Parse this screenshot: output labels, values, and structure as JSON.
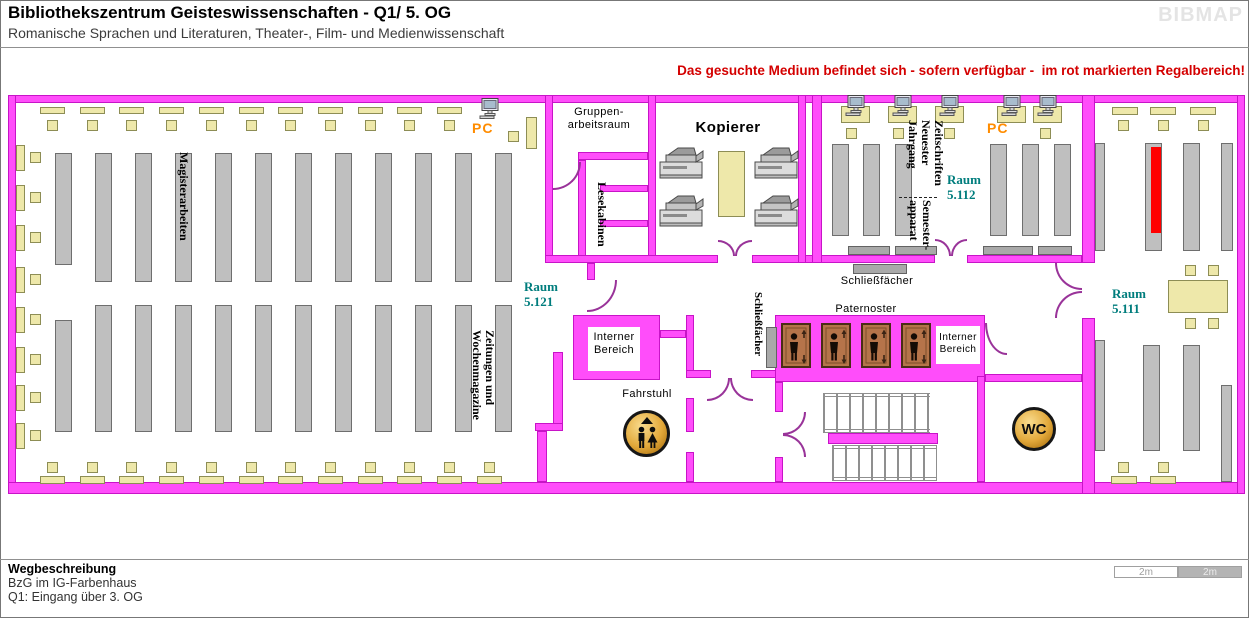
{
  "header": {
    "title": "Bibliothekszentrum Geisteswissenschaften - Q1/ 5. OG",
    "subtitle": "Romanische Sprachen und Literaturen, Theater-, Film- und Medienwissenschaft",
    "logo": "BIBMAP",
    "notice": "Das gesuchte Medium befindet sich - sofern verfügbar -  im rot markierten Regalbereich!"
  },
  "plan": {
    "rooms": {
      "gruppenarbeitsraum": "Gruppen-\narbeitsraum",
      "lesekabinen": "Lesekabinen",
      "kopierer": "Kopierer",
      "raum_5121": "Raum\n5.121",
      "raum_5112": "Raum\n5.112",
      "raum_5111": "Raum\n5.111",
      "interner_bereich_links": "Interner\nBereich",
      "interner_bereich_rechts": "Interner\nBereich",
      "fahrstuhl": "Fahrstuhl",
      "wc": "WC",
      "paternoster": "Paternoster"
    },
    "areas": {
      "magisterarbeiten": "Magisterarbeiten",
      "zeitungen": "Zeitungen und\nWochenmagazine",
      "zeitschriften": "Zeitschriften\nNeuester\nJahrgang",
      "semesterapparat": "Semester-\napparat",
      "schliessfaecher_oben": "Schließfächer",
      "schliessfaecher_flur": "Schließfächer",
      "pc_links": "PC",
      "pc_rechts": "PC"
    }
  },
  "footer": {
    "heading": "Wegbeschreibung",
    "line1": "BzG im IG-Farbenhaus",
    "line2": "Q1: Eingang über 3. OG",
    "scale_left": "2m",
    "scale_right": "2m"
  },
  "icons": {
    "computer": "monitor-icon",
    "kopierer": "copier-icon",
    "fahrstuhl": "elevator-people-up-icon",
    "wc": "wc-circle-icon",
    "paternoster": "person-in-cabin-icon",
    "treppe": "stairs-flight"
  },
  "colors": {
    "wall": "#ff4dfa",
    "wallb": "#c714c7",
    "door": "#993399",
    "shelf": "#bfbfbf",
    "desk": "#eee8aa",
    "hl": "#ff0000",
    "roomlbl": "#007d7d",
    "pclbl": "#ff8c00",
    "notice": "#d40000",
    "cabin": "#b5744a"
  }
}
